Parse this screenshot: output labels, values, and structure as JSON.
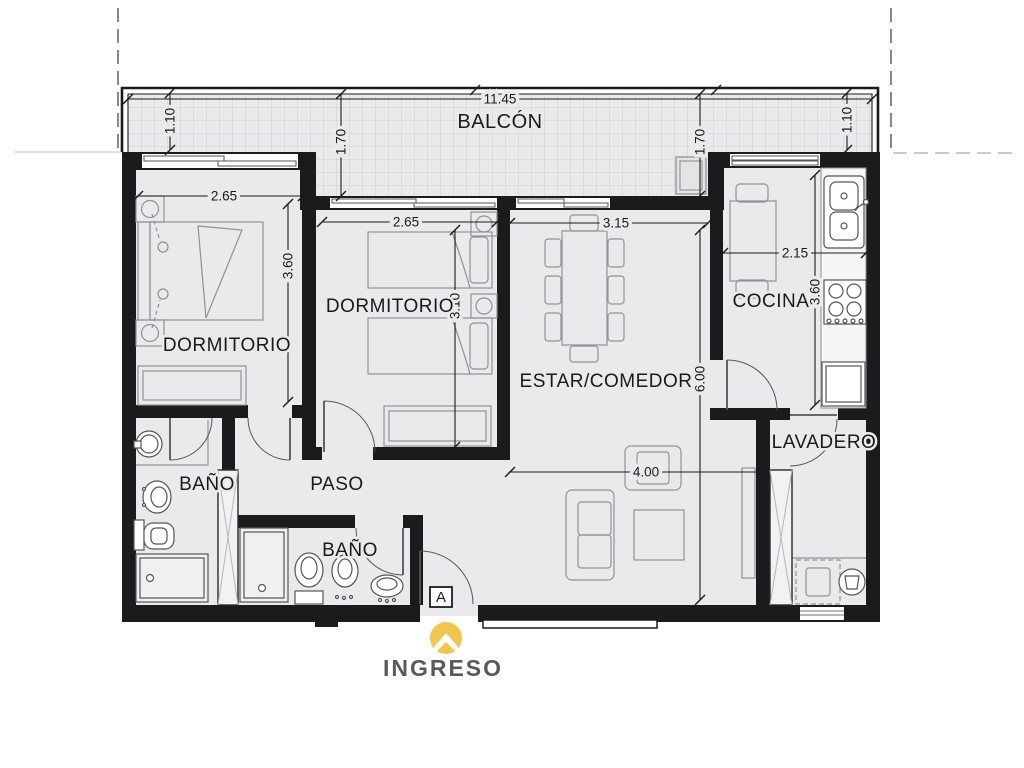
{
  "floorplan": {
    "rooms": {
      "balcony": {
        "label": "BALCÓN"
      },
      "bedroom1": {
        "label": "DORMITORIO"
      },
      "bedroom2": {
        "label": "DORMITORIO"
      },
      "living_dining": {
        "label": "ESTAR/COMEDOR"
      },
      "kitchen": {
        "label": "COCINA"
      },
      "laundry": {
        "label": "LAVADERO"
      },
      "bathroom1": {
        "label": "BAÑO"
      },
      "bathroom2": {
        "label": "BAÑO"
      },
      "hallway": {
        "label": "PASO"
      }
    },
    "dimensions": {
      "balcony_width": "11.45",
      "balcony_depth_left": "1.10",
      "balcony_depth_midleft": "1.70",
      "balcony_depth_midright": "1.70",
      "balcony_depth_right": "1.10",
      "bedroom1_width": "2.65",
      "bedroom1_depth": "3.60",
      "bedroom2_width": "2.65",
      "bedroom2_depth": "3.10",
      "living_width": "3.15",
      "living_depth": "6.00",
      "living_lower_width": "4.00",
      "kitchen_width": "2.15",
      "kitchen_depth": "3.60"
    },
    "entrance": {
      "label": "INGRESO",
      "section_marker": "A",
      "logo_icon": "home-chevron-icon"
    },
    "colors": {
      "wall": "#1b1b1b",
      "floor": "#eaeaec",
      "logo": "#F2C64A",
      "entrance_text": "#58595B"
    }
  }
}
